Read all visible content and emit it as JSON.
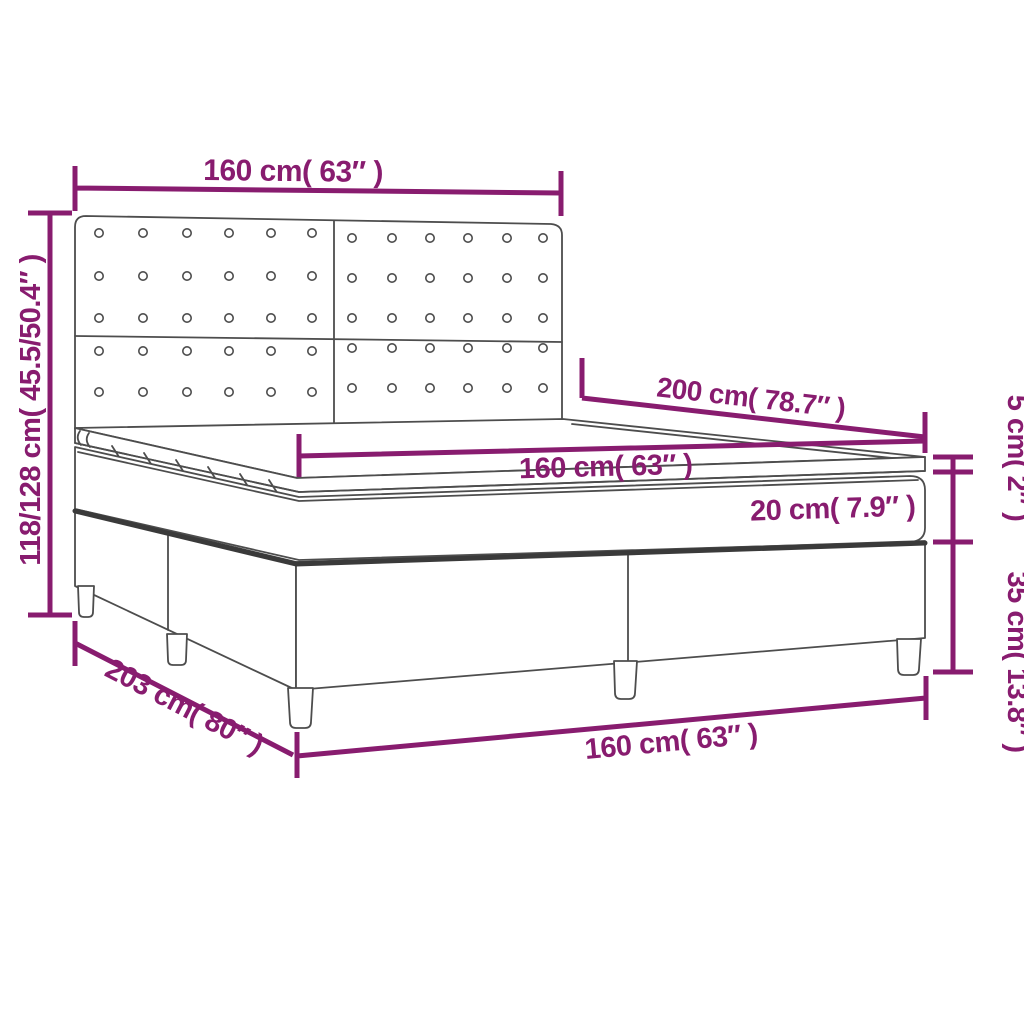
{
  "title": "Box spring bed dimension diagram",
  "colors": {
    "accent": "#881C6F",
    "line_art": "#4D4D4D",
    "background": "#FFFFFF"
  },
  "labels": {
    "headboard_width_top": "160 cm( 63″ )",
    "overall_height_left": "118/128 cm( 45.5/50.4″ )",
    "length_top_right": "200 cm( 78.7″ )",
    "mattress_width_mid": "160 cm( 63″ )",
    "mattress_height": "20 cm( 7.9″ )",
    "topper_height_right": "5 cm( 2″ )",
    "base_height_right": "35 cm( 13.8″ )",
    "base_length_bottom_left": "203 cm( 80″ )",
    "base_width_bottom": "160 cm( 63″ )"
  }
}
